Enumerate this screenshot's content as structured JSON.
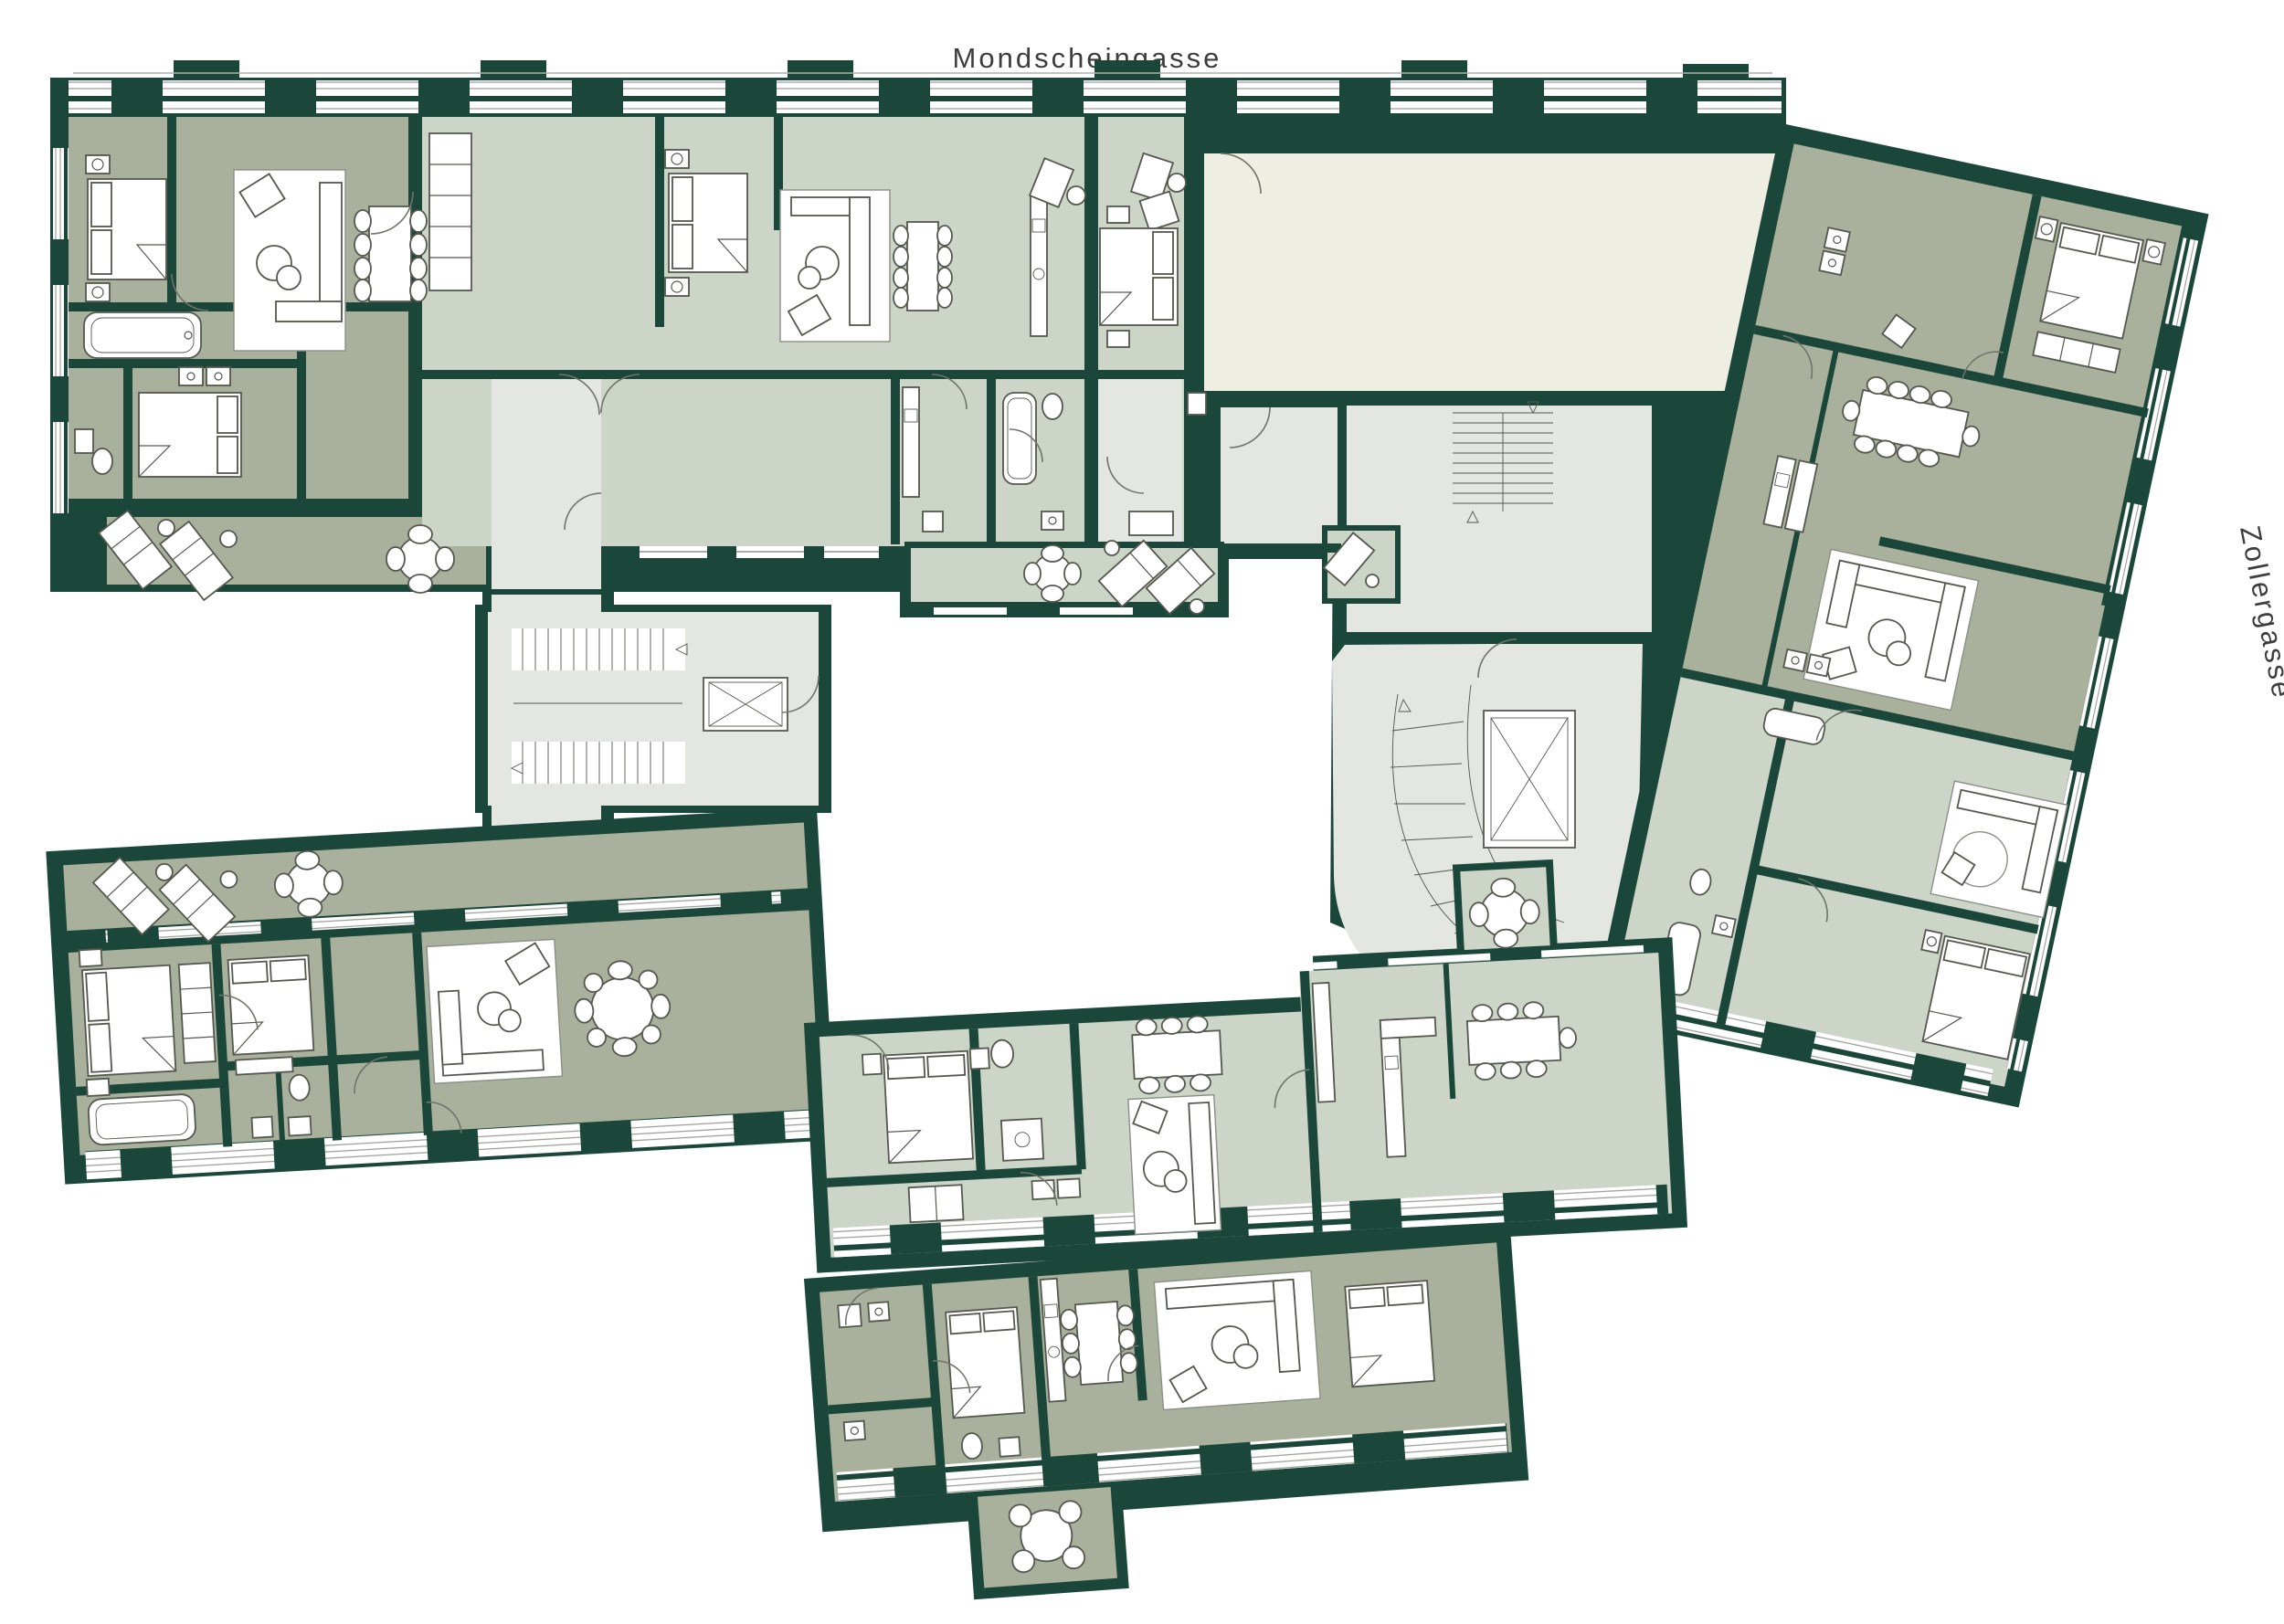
{
  "streets": {
    "top": "Mondscheingasse",
    "right": "Zollergasse"
  },
  "palette": {
    "wall": "#1a473a",
    "unit_dark": "#a9b09c",
    "unit_light": "#cdd5c9",
    "common": "#e3e6e1",
    "courtyard": "#efeee3",
    "paper": "#ffffff",
    "line": "#55584f",
    "label": "#3d3d3b"
  }
}
